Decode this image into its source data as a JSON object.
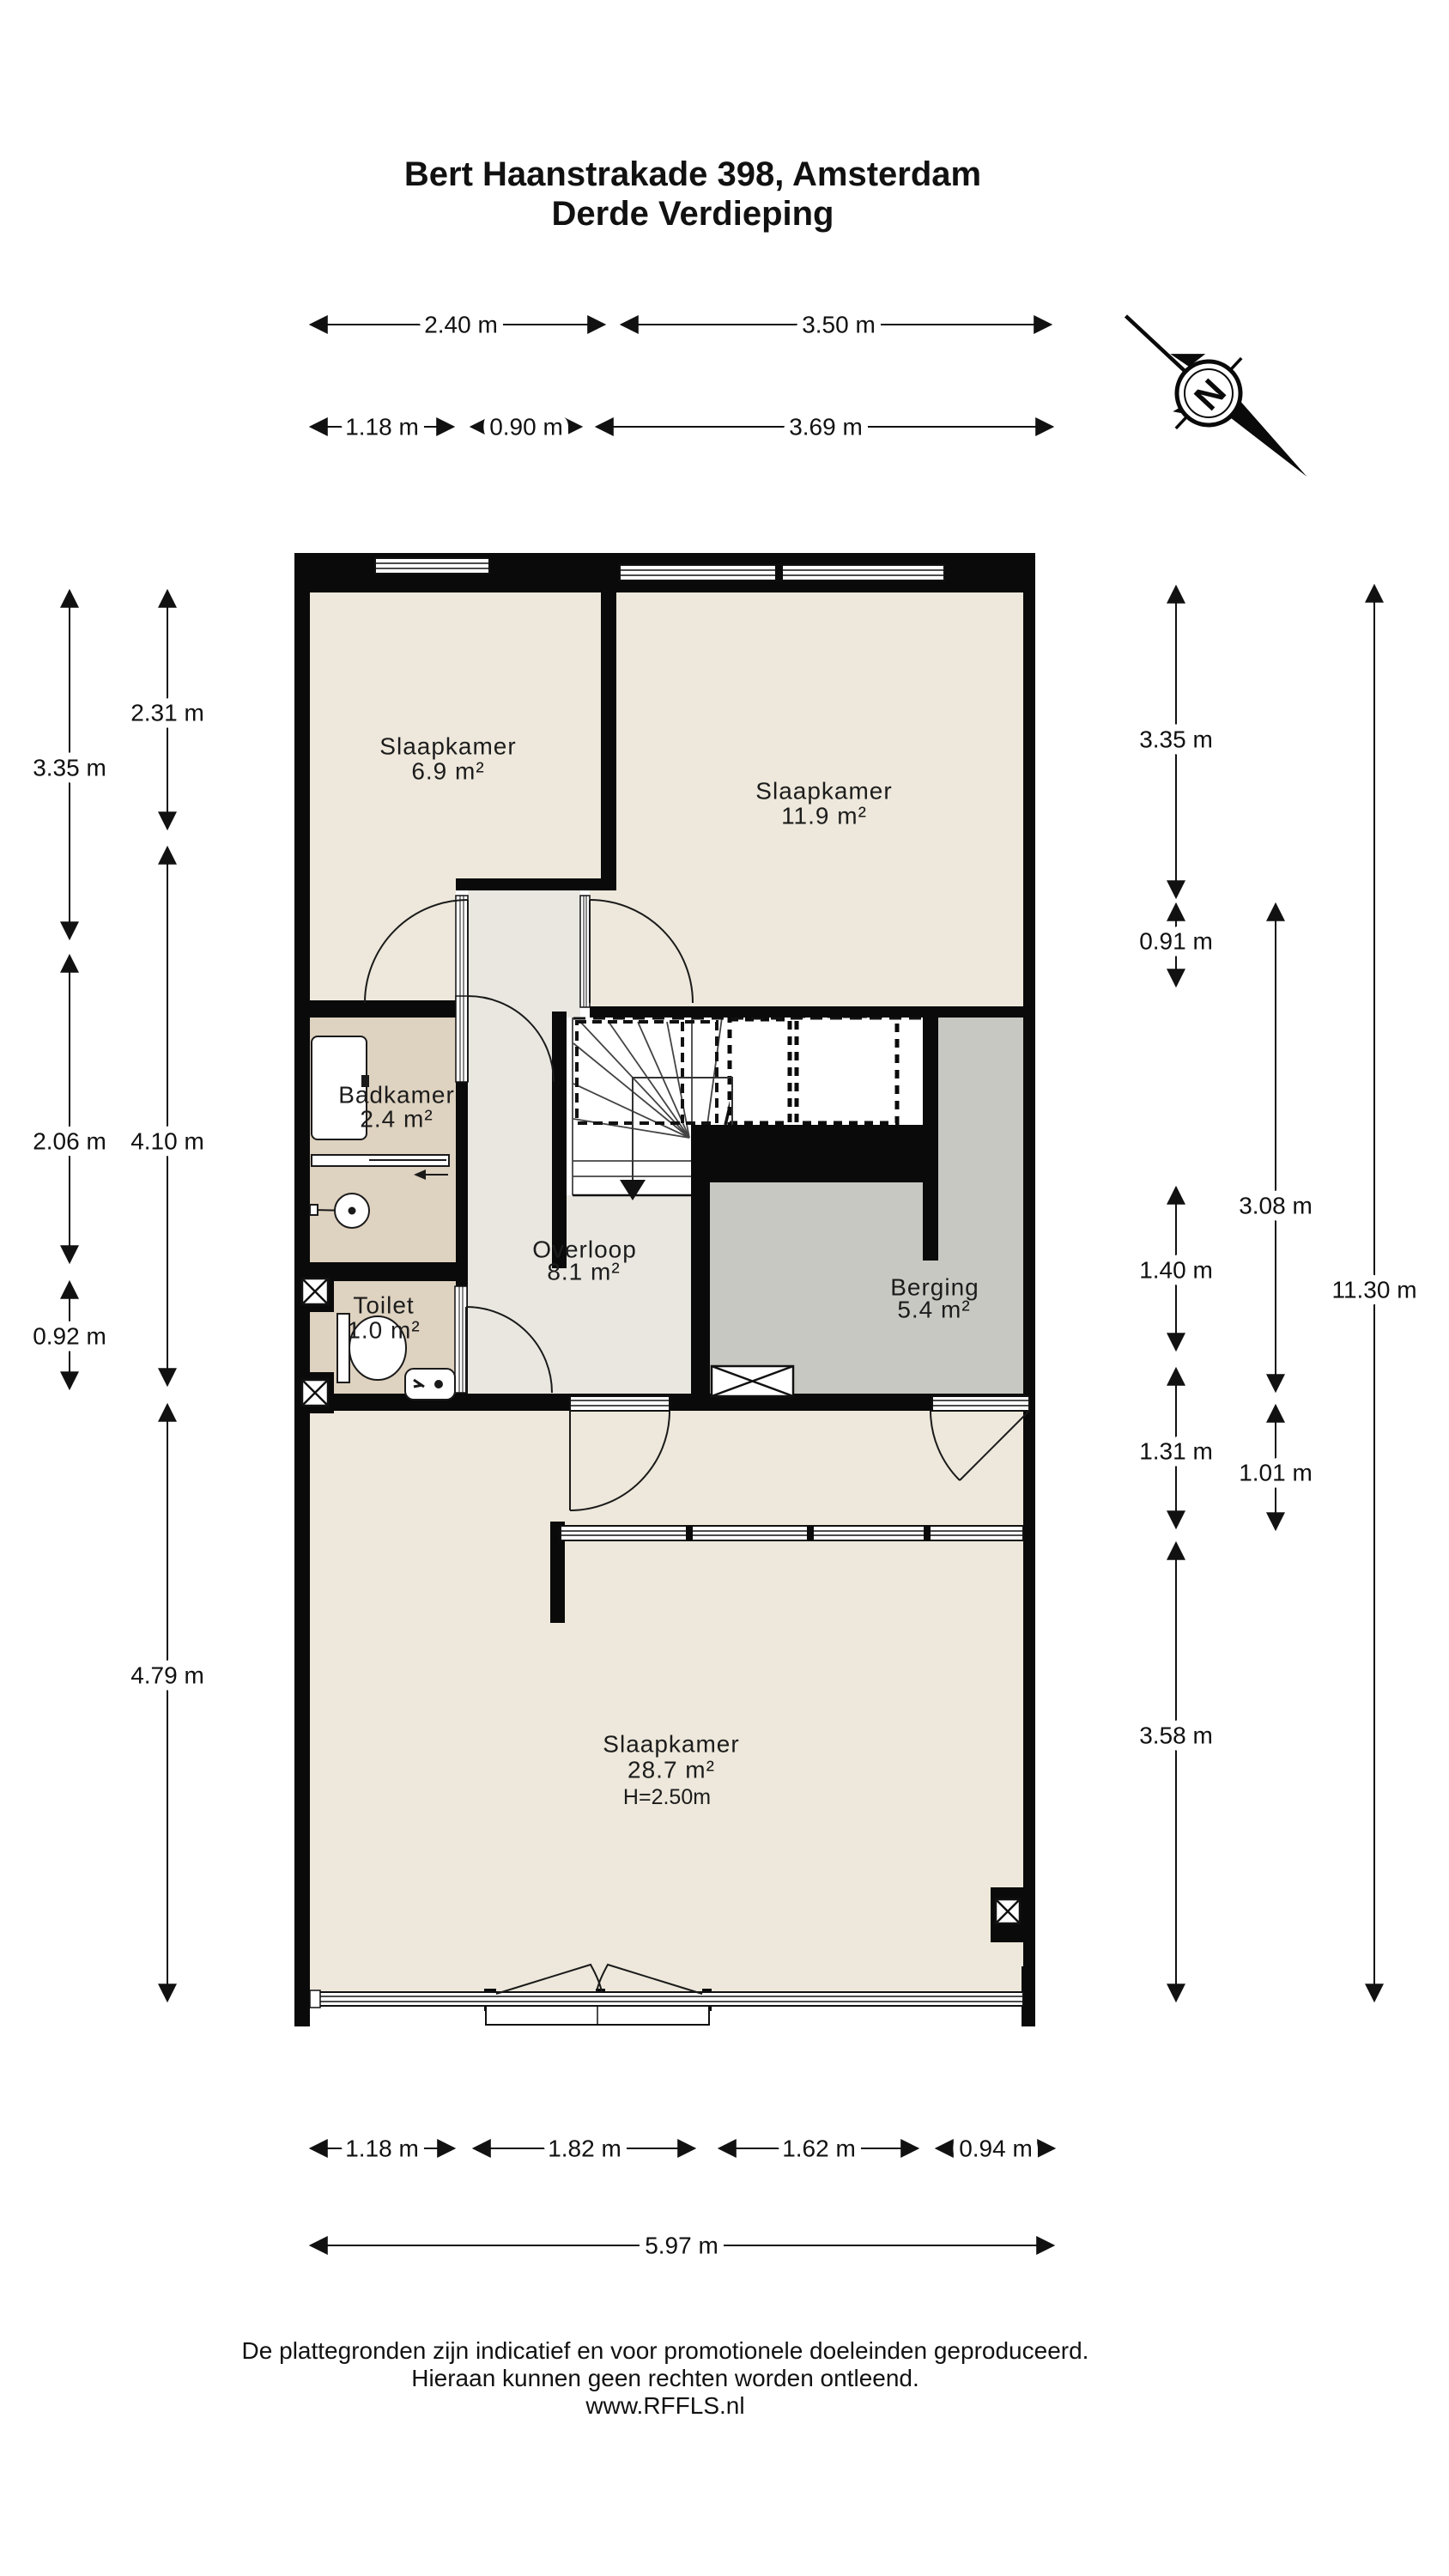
{
  "title": {
    "line1": "Bert Haanstrakade 398, Amsterdam",
    "line2": "Derde Verdieping"
  },
  "compass": {
    "label": "N"
  },
  "rooms": {
    "slaapkamer1": {
      "name": "Slaapkamer",
      "area": "6.9 m²"
    },
    "slaapkamer2": {
      "name": "Slaapkamer",
      "area": "11.9 m²"
    },
    "badkamer": {
      "name": "Badkamer",
      "area": "2.4 m²"
    },
    "overloop": {
      "name": "Overloop",
      "area": "8.1 m²"
    },
    "berging": {
      "name": "Berging",
      "area": "5.4 m²"
    },
    "toilet": {
      "name": "Toilet",
      "area": "1.0 m²"
    },
    "slaapkamer3": {
      "name": "Slaapkamer",
      "area": "28.7 m²",
      "ceiling": "H=2.50m"
    }
  },
  "dimensions": {
    "top_row1": [
      "2.40 m",
      "3.50 m"
    ],
    "top_row2": [
      "1.18 m",
      "0.90 m",
      "3.69 m"
    ],
    "left_outer": [
      "3.35 m",
      "2.06 m",
      "0.92 m"
    ],
    "left_inner": [
      "2.31 m",
      "4.10 m",
      "4.79 m"
    ],
    "right_col1": [
      "3.35 m",
      "0.91 m",
      "1.40 m",
      "1.31 m",
      "3.58 m"
    ],
    "right_col2": [
      "3.08 m",
      "1.01 m"
    ],
    "right_col3": [
      "11.30 m"
    ],
    "bottom_row1": [
      "1.18 m",
      "1.82 m",
      "1.62 m",
      "0.94 m"
    ],
    "bottom_row2": [
      "5.97 m"
    ]
  },
  "footer": {
    "line1": "De plattegronden zijn indicatief en voor promotionele doeleinden geproduceerd.",
    "line2": "Hieraan kunnen geen rechten worden ontleend.",
    "line3": "www.RFFLS.nl"
  },
  "colors": {
    "floor_beige": "#EDE8DB",
    "hall_grey": "#E9E7E0",
    "bath_tan": "#DED2C0",
    "storage_grey": "#C8C8C3",
    "wall_black": "#0A0A0A"
  }
}
